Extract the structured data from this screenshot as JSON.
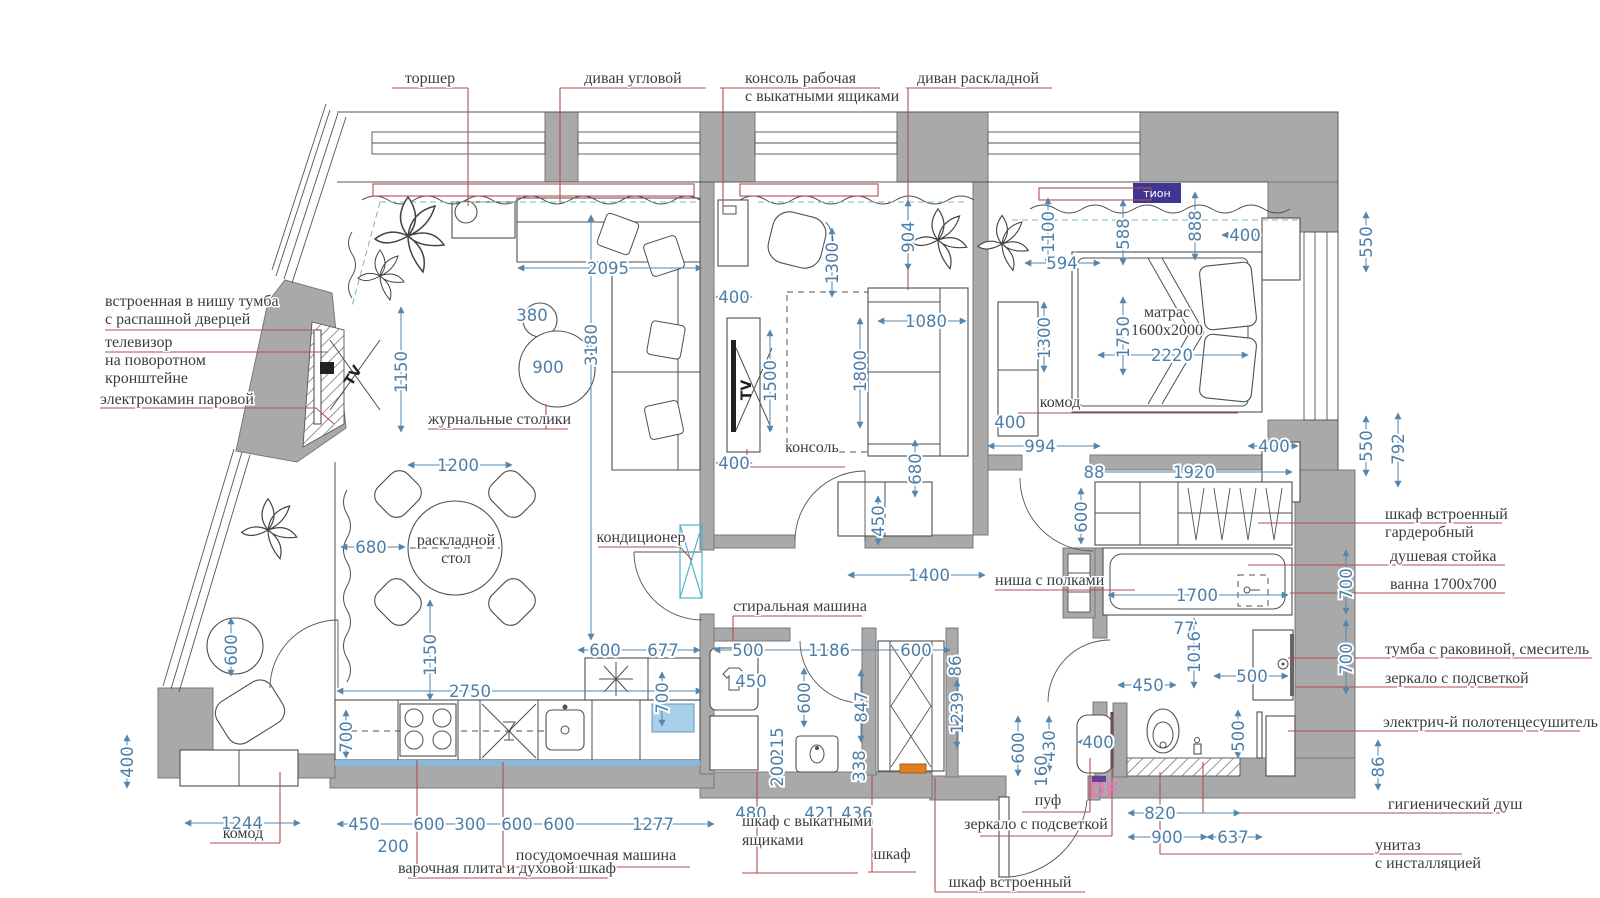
{
  "plan_name": "apartment-furniture-plan",
  "colors": {
    "wall_gray": "#a9a9a9",
    "dimension_blue": "#4d7ea8",
    "leader_red": "#b24d4d",
    "tion_purple": "#3f3693",
    "df_pink": "#e87ab2",
    "highlight_blue": "#aacfe8",
    "accent_orange": "#df7f1f"
  },
  "badges": {
    "tion": "тион",
    "df": "DF"
  },
  "annotations": [
    [
      "торшер",
      430,
      83,
      "m"
    ],
    [
      "диван угловой",
      633,
      83,
      "m"
    ],
    [
      "консоль рабочая",
      745,
      83,
      "s"
    ],
    [
      "с выкатными ящиками",
      745,
      101,
      "s"
    ],
    [
      "диван раскладной",
      978,
      83,
      "m"
    ],
    [
      "встроенная в нишу тумба",
      105,
      306,
      "s"
    ],
    [
      "с распашной дверцей",
      105,
      324,
      "s"
    ],
    [
      "телевизор",
      105,
      347,
      "s"
    ],
    [
      "на поворотном",
      105,
      365,
      "s"
    ],
    [
      "кронштейне",
      105,
      383,
      "s"
    ],
    [
      "электрокамин паровой",
      100,
      404,
      "s"
    ],
    [
      "журнальные столики",
      428,
      424,
      "s"
    ],
    [
      "раскладной",
      456,
      545,
      "m"
    ],
    [
      "стол",
      456,
      563,
      "m"
    ],
    [
      "кондиционер",
      641,
      542,
      "m"
    ],
    [
      "консоль",
      812,
      452,
      "m"
    ],
    [
      "матрас",
      1167,
      317,
      "m"
    ],
    [
      "1600x2000",
      1167,
      335,
      "m"
    ],
    [
      "комод",
      1060,
      407,
      "m"
    ],
    [
      "ниша с полками",
      995,
      585,
      "s"
    ],
    [
      "стиральная машина",
      800,
      611,
      "m"
    ],
    [
      "комод",
      243,
      838,
      "m"
    ],
    [
      "варочная плита и духовой шкаф",
      507,
      873,
      "m"
    ],
    [
      "посудомоечная машина",
      596,
      860,
      "m"
    ],
    [
      "шкаф с выкатными",
      742,
      826,
      "s"
    ],
    [
      "ящиками",
      742,
      845,
      "s"
    ],
    [
      "шкаф",
      892,
      859,
      "m"
    ],
    [
      "шкаф встроенный",
      1010,
      887,
      "m"
    ],
    [
      "пуф",
      1048,
      805,
      "m"
    ],
    [
      "зеркало с подсветкой",
      1036,
      829,
      "m"
    ],
    [
      "шкаф встроенный",
      1385,
      519,
      "s"
    ],
    [
      "гардеробный",
      1385,
      537,
      "s"
    ],
    [
      "душевая стойка",
      1390,
      561,
      "s"
    ],
    [
      "ванна 1700x700",
      1390,
      589,
      "s"
    ],
    [
      "тумба с раковиной, смеситель",
      1385,
      654,
      "s"
    ],
    [
      "зеркало с подсветкой",
      1385,
      683,
      "s"
    ],
    [
      "электрич-й полотенцесушитель",
      1383,
      727,
      "s"
    ],
    [
      "гигиенический душ",
      1388,
      809,
      "s"
    ],
    [
      "унитаз",
      1375,
      850,
      "s"
    ],
    [
      "с инсталляцией",
      1375,
      868,
      "s"
    ],
    [
      "TV",
      357,
      378,
      "m",
      -58,
      "tv"
    ],
    [
      "TV",
      751,
      390,
      "m",
      -90,
      "tv"
    ]
  ],
  "dimensions": [
    [
      "2095",
      608,
      274,
      0
    ],
    [
      "380",
      532,
      321,
      0
    ],
    [
      "900",
      548,
      373,
      0
    ],
    [
      "3180",
      597,
      345,
      -90
    ],
    [
      "1150",
      407,
      372,
      -90
    ],
    [
      "1200",
      458,
      471,
      0
    ],
    [
      "680",
      371,
      553,
      0
    ],
    [
      "1150",
      436,
      655,
      -90
    ],
    [
      "2750",
      470,
      697,
      0
    ],
    [
      "700",
      352,
      737,
      -90
    ],
    [
      "600",
      237,
      650,
      -90
    ],
    [
      "400",
      133,
      762,
      -90
    ],
    [
      "1244",
      242,
      829,
      0
    ],
    [
      "450",
      364,
      830,
      0
    ],
    [
      "200",
      393,
      852,
      0
    ],
    [
      "600",
      429,
      830,
      0
    ],
    [
      "300",
      470,
      830,
      0
    ],
    [
      "600",
      517,
      830,
      0
    ],
    [
      "600",
      559,
      830,
      0
    ],
    [
      "1277",
      653,
      830,
      0
    ],
    [
      "600",
      605,
      656,
      0
    ],
    [
      "677",
      663,
      656,
      0
    ],
    [
      "700",
      668,
      698,
      -90
    ],
    [
      "400",
      734,
      303,
      0
    ],
    [
      "400",
      734,
      469,
      0
    ],
    [
      "1300",
      838,
      263,
      -90
    ],
    [
      "904",
      914,
      237,
      -90
    ],
    [
      "1500",
      776,
      381,
      -90
    ],
    [
      "1800",
      866,
      371,
      -90
    ],
    [
      "1080",
      926,
      327,
      0
    ],
    [
      "680",
      921,
      469,
      -90
    ],
    [
      "450",
      884,
      521,
      -90
    ],
    [
      "1400",
      929,
      581,
      0
    ],
    [
      "500",
      748,
      656,
      0
    ],
    [
      "1186",
      829,
      656,
      0
    ],
    [
      "600",
      916,
      656,
      0
    ],
    [
      "450",
      751,
      687,
      0
    ],
    [
      "600",
      810,
      698,
      -90
    ],
    [
      "847",
      867,
      707,
      -90
    ],
    [
      "215",
      783,
      743,
      -90
    ],
    [
      "200",
      783,
      771,
      -90
    ],
    [
      "338",
      865,
      766,
      -90
    ],
    [
      "86",
      961,
      666,
      -90
    ],
    [
      "1239",
      963,
      713,
      -90
    ],
    [
      "480",
      751,
      819,
      0
    ],
    [
      "421",
      820,
      819,
      0
    ],
    [
      "436",
      857,
      819,
      0
    ],
    [
      "1100",
      1054,
      232,
      -90
    ],
    [
      "594",
      1062,
      269,
      0
    ],
    [
      "588",
      1129,
      234,
      -90
    ],
    [
      "888",
      1201,
      226,
      -90
    ],
    [
      "400",
      1245,
      241,
      0
    ],
    [
      "550",
      1372,
      242,
      -90
    ],
    [
      "1300",
      1050,
      338,
      -90
    ],
    [
      "1750",
      1129,
      337,
      -90
    ],
    [
      "2220",
      1172,
      361,
      0
    ],
    [
      "400",
      1010,
      428,
      0
    ],
    [
      "994",
      1040,
      452,
      0
    ],
    [
      "400",
      1274,
      452,
      0
    ],
    [
      "550",
      1372,
      446,
      -90
    ],
    [
      "792",
      1404,
      449,
      -90
    ],
    [
      "88",
      1094,
      478,
      0
    ],
    [
      "1920",
      1194,
      478,
      0
    ],
    [
      "600",
      1087,
      517,
      -90
    ],
    [
      "1700",
      1197,
      601,
      0
    ],
    [
      "77",
      1184,
      634,
      0
    ],
    [
      "700",
      1352,
      584,
      -90
    ],
    [
      "1016",
      1200,
      652,
      -90
    ],
    [
      "700",
      1352,
      659,
      -90
    ],
    [
      "500",
      1252,
      682,
      0
    ],
    [
      "450",
      1148,
      691,
      0
    ],
    [
      "500",
      1244,
      736,
      -90
    ],
    [
      "86",
      1384,
      767,
      -90
    ],
    [
      "600",
      1024,
      748,
      -90
    ],
    [
      "430",
      1055,
      746,
      -90
    ],
    [
      "160",
      1047,
      771,
      -90
    ],
    [
      "400",
      1098,
      748,
      0
    ],
    [
      "820",
      1160,
      819,
      0
    ],
    [
      "900",
      1167,
      843,
      0
    ],
    [
      "637",
      1233,
      843,
      0
    ]
  ]
}
